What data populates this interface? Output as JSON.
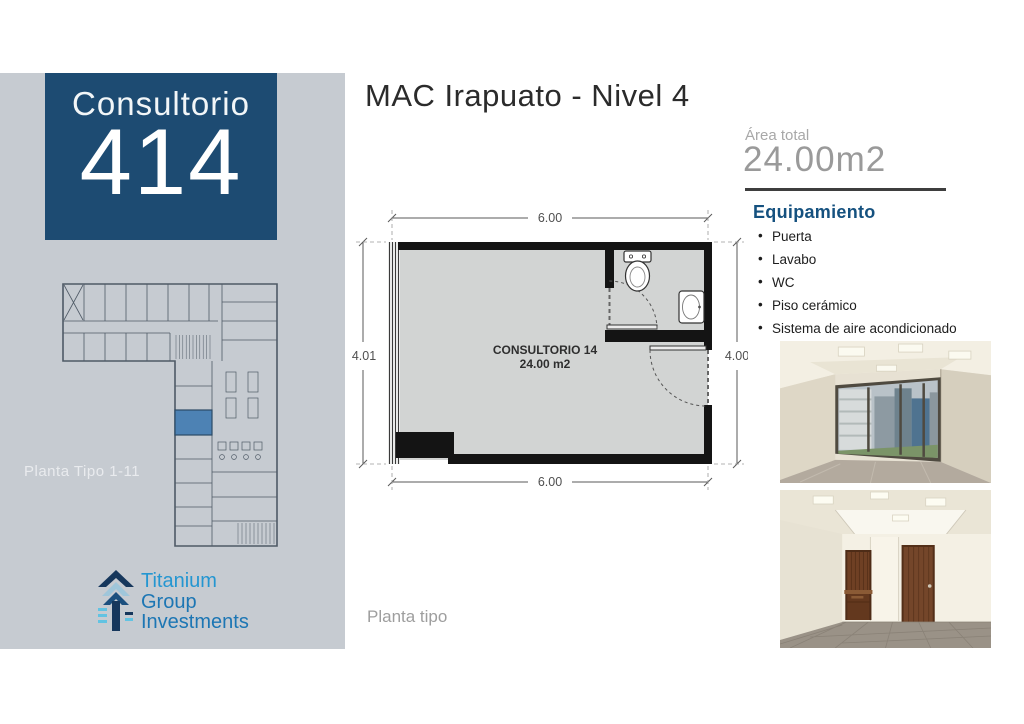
{
  "colors": {
    "sidebar_bg": "#c6cbd1",
    "card_bg": "#1d4b72",
    "heading_blue": "#15517f",
    "highlight_room": "#4d82b4",
    "wall_black": "#141414",
    "plan_floor": "#d2d4d3"
  },
  "sidebar": {
    "unit_card": {
      "label": "Consultorio",
      "number": "414"
    },
    "mini_plan_caption": "Planta Tipo 1-11",
    "logo": {
      "line1": "Titanium",
      "line2": "Group",
      "line3": "Investments"
    }
  },
  "header": {
    "title": "MAC Irapuato - Nivel 4"
  },
  "area": {
    "label": "Área total",
    "value": "24.00m2"
  },
  "equipment": {
    "heading": "Equipamiento",
    "items": [
      "Puerta",
      "Lavabo",
      "WC",
      "Piso cerámico",
      "Sistema de aire acondicionado"
    ]
  },
  "floorplan": {
    "room_label": "CONSULTORIO 14",
    "room_area": "24.00 m2",
    "caption": "Planta tipo",
    "dims": {
      "top": "6.00",
      "left": "4.01",
      "right": "4.00",
      "bottom": "6.00"
    }
  },
  "photos": [
    {
      "name": "interior-photo-window-view"
    },
    {
      "name": "interior-photo-doors-view"
    }
  ]
}
